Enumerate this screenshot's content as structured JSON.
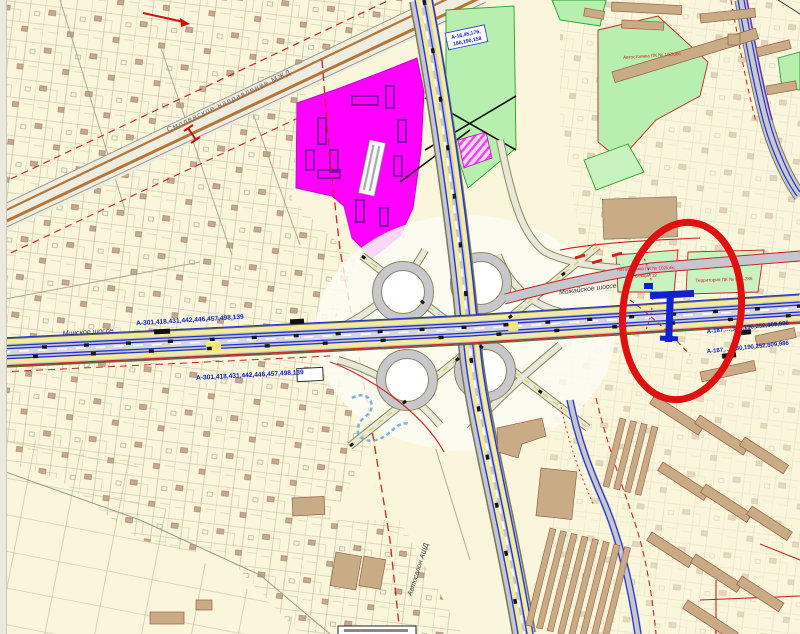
{
  "map": {
    "road_labels": {
      "railway": "Смоленское направление МЖД",
      "minskoe_shosse": "Минское шоссе",
      "mozhayskoe_shosse": "Можайское шоссе"
    },
    "cadastral_labels": {
      "west_above": "А-301,418,431,442,446,457,498,139",
      "west_below": "А-301,418,431,442,446,457,498,139",
      "north_box_line1": "А-16,45,176,",
      "north_box_line2": "180,190,158",
      "east_upper": "А-187,…,180,190,252,609,986",
      "east_lower": "А-187,…,180,190,252,609,986"
    },
    "site_labels": {
      "autosalon": "Автосалон АШД",
      "parking_1_line1": "Автостоянка ПК № 102/обс",
      "parking_1_line2": "Секция 12",
      "parking_2": "Территория ПК № 87—286",
      "parking_north": "Автостоянка ПК № 102/обс"
    },
    "annotation": {
      "shape": "ellipse",
      "color": "#e01010"
    },
    "colors": {
      "background": "#faf6dc",
      "magenta_zone": "#ff00ff",
      "green_zone": "#b6efae",
      "road_blue": "#2233cc",
      "boundary_red": "#cc2222",
      "railway_brown": "#b5763a",
      "building_tan": "#c9ab86"
    }
  }
}
